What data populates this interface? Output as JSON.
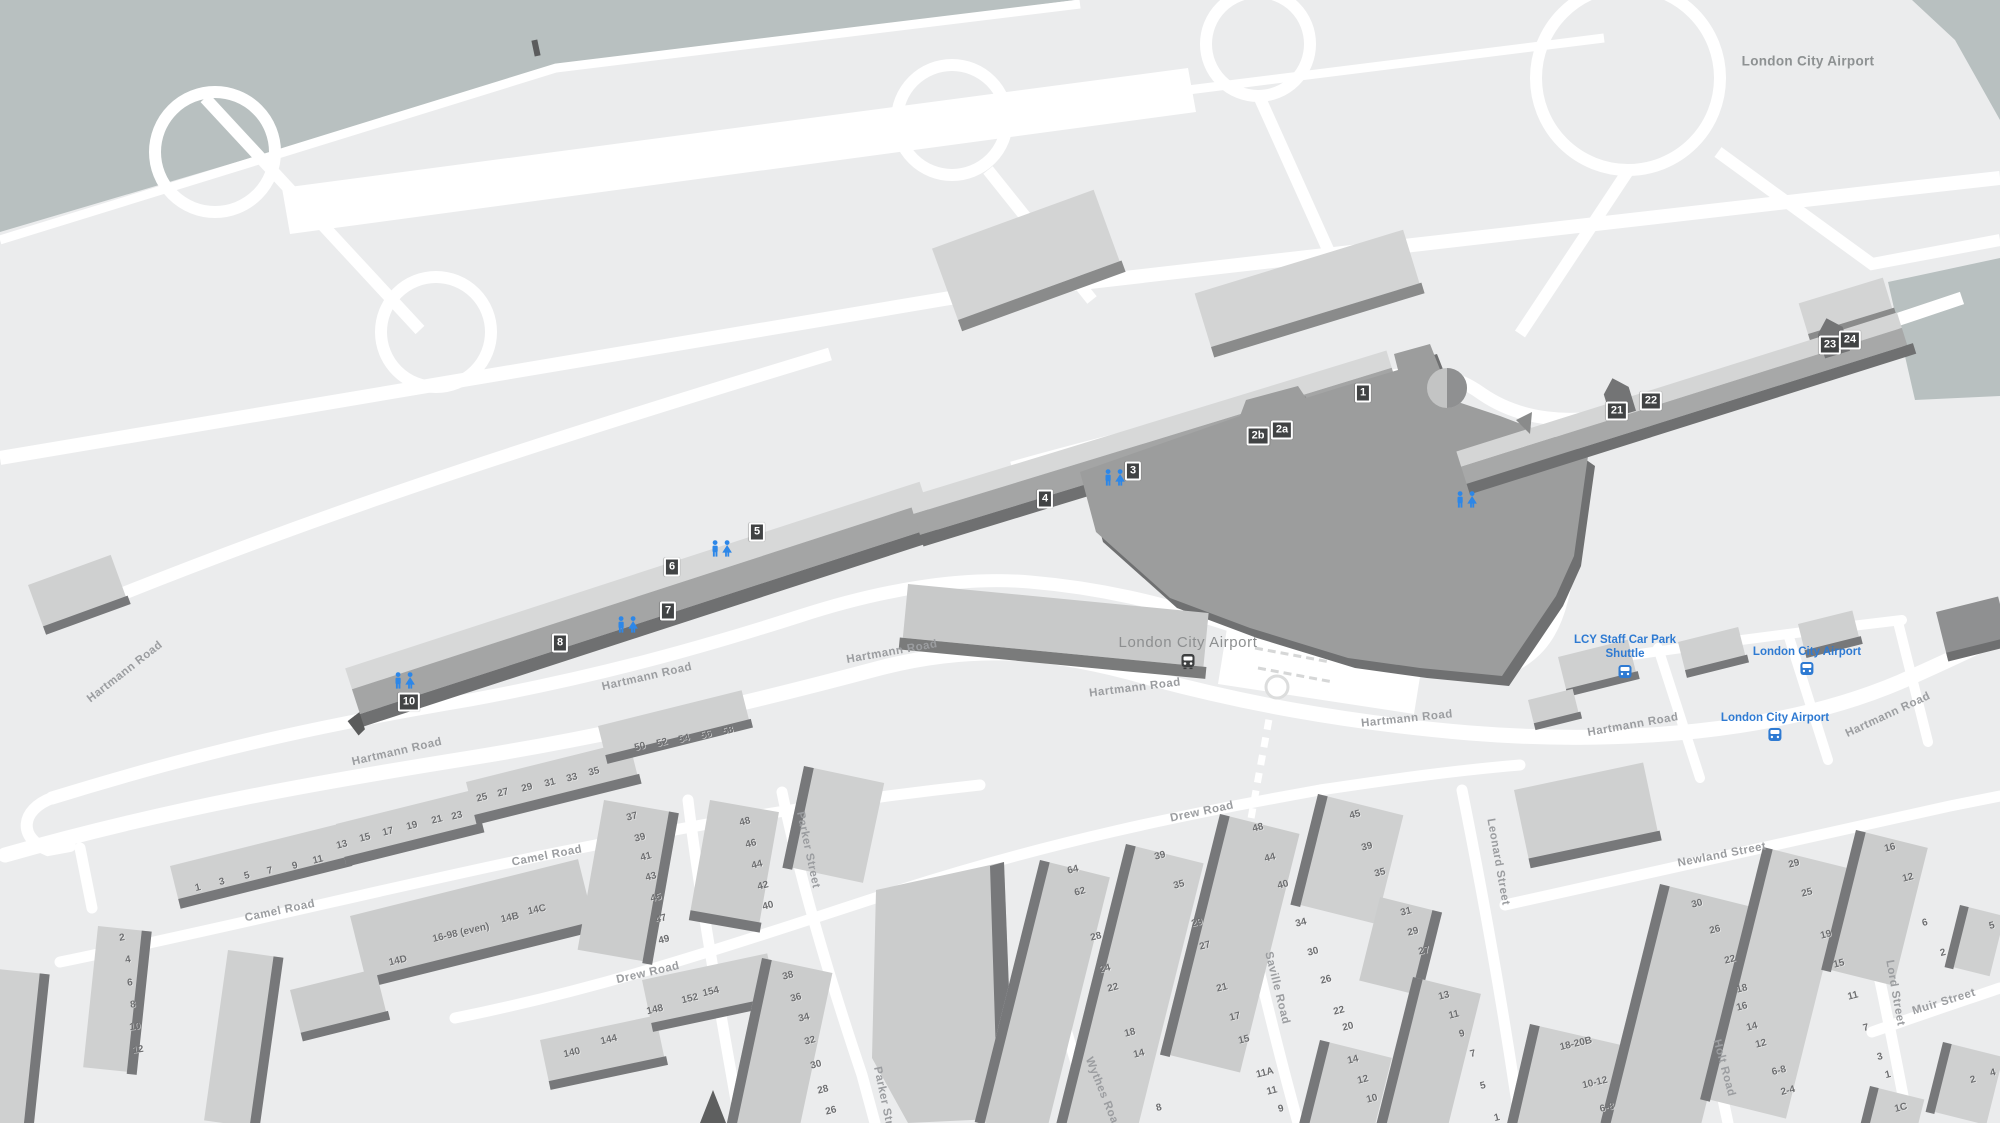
{
  "map_title": "London City Airport",
  "station": {
    "name": "London City Airport"
  },
  "bus_stops": [
    {
      "name": "LCY Staff Car Park Shuttle",
      "x": 1625,
      "y": 633,
      "wrap": true
    },
    {
      "name": "London City Airport",
      "x": 1807,
      "y": 645,
      "wrap": false
    },
    {
      "name": "London City Airport",
      "x": 1775,
      "y": 711,
      "wrap": false
    }
  ],
  "gates": [
    {
      "t": "1",
      "x": 1363,
      "y": 393
    },
    {
      "t": "2a",
      "x": 1282,
      "y": 430
    },
    {
      "t": "2b",
      "x": 1258,
      "y": 436
    },
    {
      "t": "3",
      "x": 1133,
      "y": 471
    },
    {
      "t": "4",
      "x": 1045,
      "y": 499
    },
    {
      "t": "5",
      "x": 757,
      "y": 532
    },
    {
      "t": "6",
      "x": 672,
      "y": 567
    },
    {
      "t": "7",
      "x": 668,
      "y": 611
    },
    {
      "t": "8",
      "x": 560,
      "y": 643
    },
    {
      "t": "10",
      "x": 409,
      "y": 702
    },
    {
      "t": "21",
      "x": 1617,
      "y": 411
    },
    {
      "t": "22",
      "x": 1651,
      "y": 401
    },
    {
      "t": "23",
      "x": 1830,
      "y": 345
    },
    {
      "t": "24",
      "x": 1850,
      "y": 340
    }
  ],
  "restrooms": [
    {
      "x": 405,
      "y": 683
    },
    {
      "x": 628,
      "y": 627
    },
    {
      "x": 722,
      "y": 551
    },
    {
      "x": 1115,
      "y": 480
    },
    {
      "x": 1467,
      "y": 502
    }
  ],
  "road_labels": [
    {
      "t": "Hartmann Road",
      "x": 125,
      "y": 672,
      "r": -38
    },
    {
      "t": "Hartmann Road",
      "x": 397,
      "y": 752,
      "r": -13
    },
    {
      "t": "Hartmann Road",
      "x": 647,
      "y": 677,
      "r": -13
    },
    {
      "t": "Hartmann Road",
      "x": 892,
      "y": 652,
      "r": -10
    },
    {
      "t": "Hartmann Road",
      "x": 1135,
      "y": 688,
      "r": -7
    },
    {
      "t": "Hartmann Road",
      "x": 1407,
      "y": 719,
      "r": -6
    },
    {
      "t": "Hartmann Road",
      "x": 1633,
      "y": 725,
      "r": -10
    },
    {
      "t": "Hartmann Road",
      "x": 1888,
      "y": 715,
      "r": -25
    },
    {
      "t": "Camel Road",
      "x": 280,
      "y": 911,
      "r": -12
    },
    {
      "t": "Camel Road",
      "x": 547,
      "y": 856,
      "r": -11
    },
    {
      "t": "Drew Road",
      "x": 648,
      "y": 973,
      "r": -13
    },
    {
      "t": "Drew Road",
      "x": 1202,
      "y": 812,
      "r": -12
    },
    {
      "t": "Parker Street",
      "x": 808,
      "y": 850,
      "r": 78
    },
    {
      "t": "Parker Street",
      "x": 885,
      "y": 1105,
      "r": 78
    },
    {
      "t": "Saville Road",
      "x": 1277,
      "y": 988,
      "r": 76
    },
    {
      "t": "Wythes Road",
      "x": 1103,
      "y": 1094,
      "r": 68
    },
    {
      "t": "Leonard Street",
      "x": 1498,
      "y": 862,
      "r": 80
    },
    {
      "t": "Newland Street",
      "x": 1722,
      "y": 855,
      "r": -11
    },
    {
      "t": "Holt Road",
      "x": 1724,
      "y": 1068,
      "r": 75
    },
    {
      "t": "Lord Street",
      "x": 1895,
      "y": 993,
      "r": 80
    },
    {
      "t": "Muir Street",
      "x": 1944,
      "y": 1002,
      "r": -17
    }
  ],
  "house_numbers": [
    {
      "t": "1",
      "x": 198,
      "y": 888,
      "r": -14
    },
    {
      "t": "3",
      "x": 222,
      "y": 882,
      "r": -14
    },
    {
      "t": "5",
      "x": 247,
      "y": 876,
      "r": -14
    },
    {
      "t": "7",
      "x": 270,
      "y": 871,
      "r": -14
    },
    {
      "t": "9",
      "x": 295,
      "y": 866,
      "r": -14
    },
    {
      "t": "11",
      "x": 318,
      "y": 860,
      "r": -14
    },
    {
      "t": "13",
      "x": 342,
      "y": 845,
      "r": -14
    },
    {
      "t": "15",
      "x": 365,
      "y": 838,
      "r": -14
    },
    {
      "t": "17",
      "x": 388,
      "y": 832,
      "r": -14
    },
    {
      "t": "19",
      "x": 412,
      "y": 826,
      "r": -14
    },
    {
      "t": "21",
      "x": 437,
      "y": 820,
      "r": -14
    },
    {
      "t": "23",
      "x": 457,
      "y": 816,
      "r": -14
    },
    {
      "t": "25",
      "x": 482,
      "y": 798,
      "r": -14
    },
    {
      "t": "27",
      "x": 503,
      "y": 793,
      "r": -14
    },
    {
      "t": "29",
      "x": 527,
      "y": 788,
      "r": -14
    },
    {
      "t": "31",
      "x": 550,
      "y": 783,
      "r": -14
    },
    {
      "t": "33",
      "x": 572,
      "y": 778,
      "r": -14
    },
    {
      "t": "35",
      "x": 594,
      "y": 772,
      "r": -14
    },
    {
      "t": "50",
      "x": 640,
      "y": 747,
      "r": -14
    },
    {
      "t": "52",
      "x": 662,
      "y": 743,
      "r": -14
    },
    {
      "t": "54",
      "x": 684,
      "y": 739,
      "r": -14
    },
    {
      "t": "56",
      "x": 706,
      "y": 735,
      "r": -14
    },
    {
      "t": "58",
      "x": 728,
      "y": 731,
      "r": -14
    },
    {
      "t": "2",
      "x": 122,
      "y": 938,
      "r": -8
    },
    {
      "t": "4",
      "x": 128,
      "y": 960,
      "r": -8
    },
    {
      "t": "6",
      "x": 130,
      "y": 983,
      "r": -8
    },
    {
      "t": "8",
      "x": 133,
      "y": 1005,
      "r": -8
    },
    {
      "t": "10",
      "x": 135,
      "y": 1027,
      "r": -8
    },
    {
      "t": "12",
      "x": 138,
      "y": 1050,
      "r": -8
    },
    {
      "t": "14D",
      "x": 398,
      "y": 961,
      "r": -13
    },
    {
      "t": "16-98 (even)",
      "x": 461,
      "y": 933,
      "r": -13
    },
    {
      "t": "14B",
      "x": 510,
      "y": 918,
      "r": -13
    },
    {
      "t": "14C",
      "x": 537,
      "y": 910,
      "r": -13
    },
    {
      "t": "37",
      "x": 632,
      "y": 817,
      "r": -14
    },
    {
      "t": "39",
      "x": 640,
      "y": 838,
      "r": -14
    },
    {
      "t": "41",
      "x": 646,
      "y": 857,
      "r": -14
    },
    {
      "t": "43",
      "x": 651,
      "y": 877,
      "r": -14
    },
    {
      "t": "45",
      "x": 656,
      "y": 898,
      "r": -14
    },
    {
      "t": "47",
      "x": 661,
      "y": 919,
      "r": -14
    },
    {
      "t": "49",
      "x": 664,
      "y": 940,
      "r": -14
    },
    {
      "t": "48",
      "x": 745,
      "y": 822,
      "r": -14
    },
    {
      "t": "46",
      "x": 751,
      "y": 844,
      "r": -14
    },
    {
      "t": "44",
      "x": 757,
      "y": 865,
      "r": -14
    },
    {
      "t": "42",
      "x": 763,
      "y": 886,
      "r": -14
    },
    {
      "t": "40",
      "x": 768,
      "y": 906,
      "r": -14
    },
    {
      "t": "140",
      "x": 572,
      "y": 1053,
      "r": -13
    },
    {
      "t": "144",
      "x": 609,
      "y": 1040,
      "r": -13
    },
    {
      "t": "148",
      "x": 655,
      "y": 1010,
      "r": -13
    },
    {
      "t": "152",
      "x": 690,
      "y": 999,
      "r": -13
    },
    {
      "t": "154",
      "x": 711,
      "y": 992,
      "r": -13
    },
    {
      "t": "38",
      "x": 788,
      "y": 976,
      "r": -14
    },
    {
      "t": "36",
      "x": 796,
      "y": 998,
      "r": -14
    },
    {
      "t": "34",
      "x": 804,
      "y": 1018,
      "r": -14
    },
    {
      "t": "32",
      "x": 810,
      "y": 1041,
      "r": -14
    },
    {
      "t": "30",
      "x": 816,
      "y": 1065,
      "r": -14
    },
    {
      "t": "28",
      "x": 823,
      "y": 1090,
      "r": -14
    },
    {
      "t": "26",
      "x": 831,
      "y": 1111,
      "r": -14
    },
    {
      "t": "64",
      "x": 1073,
      "y": 870,
      "r": -14
    },
    {
      "t": "62",
      "x": 1080,
      "y": 892,
      "r": -14
    },
    {
      "t": "28",
      "x": 1096,
      "y": 937,
      "r": -14
    },
    {
      "t": "24",
      "x": 1105,
      "y": 969,
      "r": -14
    },
    {
      "t": "22",
      "x": 1113,
      "y": 988,
      "r": -14
    },
    {
      "t": "18",
      "x": 1130,
      "y": 1033,
      "r": -14
    },
    {
      "t": "14",
      "x": 1139,
      "y": 1054,
      "r": -14
    },
    {
      "t": "8",
      "x": 1159,
      "y": 1108,
      "r": -14
    },
    {
      "t": "39",
      "x": 1160,
      "y": 856,
      "r": -14
    },
    {
      "t": "35",
      "x": 1179,
      "y": 885,
      "r": -14
    },
    {
      "t": "29",
      "x": 1197,
      "y": 923,
      "r": -14
    },
    {
      "t": "27",
      "x": 1205,
      "y": 946,
      "r": -14
    },
    {
      "t": "21",
      "x": 1222,
      "y": 988,
      "r": -14
    },
    {
      "t": "17",
      "x": 1235,
      "y": 1017,
      "r": -14
    },
    {
      "t": "15",
      "x": 1244,
      "y": 1040,
      "r": -14
    },
    {
      "t": "11A",
      "x": 1265,
      "y": 1073,
      "r": -14
    },
    {
      "t": "11",
      "x": 1272,
      "y": 1091,
      "r": -14
    },
    {
      "t": "9",
      "x": 1281,
      "y": 1109,
      "r": -14
    },
    {
      "t": "48",
      "x": 1258,
      "y": 828,
      "r": -14
    },
    {
      "t": "44",
      "x": 1270,
      "y": 858,
      "r": -14
    },
    {
      "t": "40",
      "x": 1283,
      "y": 885,
      "r": -14
    },
    {
      "t": "34",
      "x": 1301,
      "y": 923,
      "r": -14
    },
    {
      "t": "30",
      "x": 1313,
      "y": 952,
      "r": -14
    },
    {
      "t": "26",
      "x": 1326,
      "y": 980,
      "r": -14
    },
    {
      "t": "22",
      "x": 1339,
      "y": 1011,
      "r": -14
    },
    {
      "t": "20",
      "x": 1348,
      "y": 1027,
      "r": -14
    },
    {
      "t": "45",
      "x": 1355,
      "y": 815,
      "r": -14
    },
    {
      "t": "39",
      "x": 1367,
      "y": 847,
      "r": -14
    },
    {
      "t": "35",
      "x": 1380,
      "y": 873,
      "r": -14
    },
    {
      "t": "31",
      "x": 1406,
      "y": 912,
      "r": -14
    },
    {
      "t": "29",
      "x": 1413,
      "y": 932,
      "r": -14
    },
    {
      "t": "27",
      "x": 1424,
      "y": 951,
      "r": -14
    },
    {
      "t": "14",
      "x": 1353,
      "y": 1060,
      "r": -14
    },
    {
      "t": "12",
      "x": 1363,
      "y": 1080,
      "r": -14
    },
    {
      "t": "10",
      "x": 1372,
      "y": 1099,
      "r": -14
    },
    {
      "t": "13",
      "x": 1444,
      "y": 996,
      "r": -14
    },
    {
      "t": "11",
      "x": 1454,
      "y": 1015,
      "r": -14
    },
    {
      "t": "9",
      "x": 1462,
      "y": 1034,
      "r": -14
    },
    {
      "t": "7",
      "x": 1473,
      "y": 1054,
      "r": -14
    },
    {
      "t": "5",
      "x": 1483,
      "y": 1086,
      "r": -14
    },
    {
      "t": "1",
      "x": 1497,
      "y": 1118,
      "r": -14
    },
    {
      "t": "18-20B",
      "x": 1576,
      "y": 1044,
      "r": -13
    },
    {
      "t": "10-12",
      "x": 1595,
      "y": 1083,
      "r": -13
    },
    {
      "t": "6-8",
      "x": 1607,
      "y": 1108,
      "r": -13
    },
    {
      "t": "30",
      "x": 1697,
      "y": 904,
      "r": -14
    },
    {
      "t": "26",
      "x": 1715,
      "y": 930,
      "r": -14
    },
    {
      "t": "22",
      "x": 1730,
      "y": 960,
      "r": -14
    },
    {
      "t": "18",
      "x": 1742,
      "y": 989,
      "r": -14
    },
    {
      "t": "16",
      "x": 1742,
      "y": 1007,
      "r": -14
    },
    {
      "t": "14",
      "x": 1752,
      "y": 1027,
      "r": -14
    },
    {
      "t": "12",
      "x": 1761,
      "y": 1044,
      "r": -14
    },
    {
      "t": "6-8",
      "x": 1779,
      "y": 1071,
      "r": -14
    },
    {
      "t": "2-4",
      "x": 1788,
      "y": 1091,
      "r": -14
    },
    {
      "t": "29",
      "x": 1794,
      "y": 864,
      "r": -14
    },
    {
      "t": "25",
      "x": 1807,
      "y": 893,
      "r": -14
    },
    {
      "t": "19",
      "x": 1826,
      "y": 935,
      "r": -14
    },
    {
      "t": "15",
      "x": 1839,
      "y": 964,
      "r": -14
    },
    {
      "t": "11",
      "x": 1853,
      "y": 996,
      "r": -14
    },
    {
      "t": "7",
      "x": 1866,
      "y": 1028,
      "r": -14
    },
    {
      "t": "3",
      "x": 1880,
      "y": 1057,
      "r": -14
    },
    {
      "t": "1",
      "x": 1888,
      "y": 1075,
      "r": -14
    },
    {
      "t": "1C",
      "x": 1901,
      "y": 1108,
      "r": -14
    },
    {
      "t": "16",
      "x": 1890,
      "y": 848,
      "r": -14
    },
    {
      "t": "12",
      "x": 1908,
      "y": 878,
      "r": -14
    },
    {
      "t": "6",
      "x": 1925,
      "y": 923,
      "r": -14
    },
    {
      "t": "2",
      "x": 1943,
      "y": 953,
      "r": -14
    },
    {
      "t": "5",
      "x": 1992,
      "y": 926,
      "r": -14
    },
    {
      "t": "2",
      "x": 1973,
      "y": 1080,
      "r": -14
    },
    {
      "t": "4",
      "x": 1993,
      "y": 1073,
      "r": -14
    }
  ],
  "colors": {
    "water": "#b8c0c0",
    "land": "#ebeced",
    "road": "#ffffff",
    "building_light": "#cfd0d0",
    "building_edge": "#77787a",
    "terminal": "#9c9d9d",
    "terminal_edge": "#6f7071",
    "transit_blue": "#2e7ad2",
    "restroom_blue": "#2d87e8",
    "gate_badge": "#414344"
  }
}
